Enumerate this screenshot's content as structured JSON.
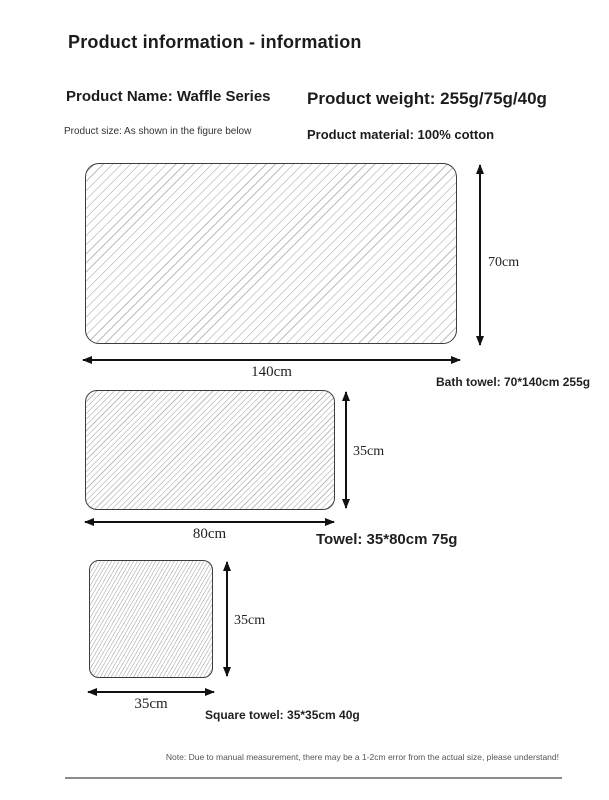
{
  "header": {
    "title": "Product information - information"
  },
  "info": {
    "product_name": "Product Name: Waffle Series",
    "product_size": "Product size: As shown in the figure below",
    "product_weight": "Product weight: 255g/75g/40g",
    "product_material": "Product material: 100% cotton"
  },
  "figures": [
    {
      "name": "bath-towel",
      "height_label": "70cm",
      "width_label": "140cm",
      "caption": "Bath towel: 70*140cm 255g"
    },
    {
      "name": "towel",
      "height_label": "35cm",
      "width_label": "80cm",
      "caption": "Towel: 35*80cm 75g"
    },
    {
      "name": "square-towel",
      "height_label": "35cm",
      "width_label": "35cm",
      "caption": "Square towel: 35*35cm 40g"
    }
  ],
  "footer": {
    "note": "Note: Due to manual measurement, there may be a 1-2cm error from the actual size, please understand!"
  },
  "colors": {
    "text": "#1c1c1c",
    "hatch_line": "#bdbdbd",
    "rect_border": "#3c3c3c",
    "arrow": "#111111",
    "note_text": "#555555",
    "divider": "#8c8c8c"
  }
}
